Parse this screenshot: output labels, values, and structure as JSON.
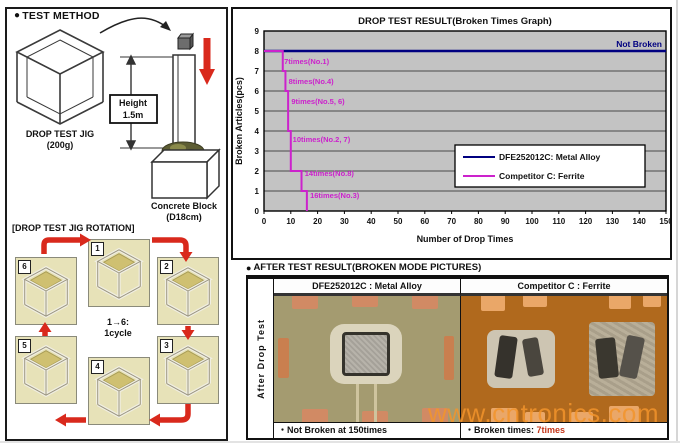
{
  "icons": {
    "bullet": "●"
  },
  "colors": {
    "arrow_red": "#d9291c",
    "navy": "#000080",
    "magenta": "#cc22cc",
    "plot_bg": "#c3c3c3",
    "photo_left_bg": "#a49b70",
    "photo_right_bg": "#b0691d",
    "watermark_orange": "#f29430"
  },
  "left_panel": {
    "title": "TEST METHOD",
    "jig": {
      "label": "DROP TEST JIG",
      "weight": "(200g)"
    },
    "height_box": {
      "line1": "Height",
      "line2": "1.5m"
    },
    "block": {
      "label": "Concrete Block",
      "size": "(D18cm)"
    },
    "rotation": {
      "title": "[DROP TEST JIG ROTATION]",
      "cycle_note_line1": "1→6:",
      "cycle_note_line2": "1cycle",
      "photo_numbers": [
        "1",
        "2",
        "3",
        "4",
        "5",
        "6"
      ]
    }
  },
  "chart_data": {
    "type": "line",
    "title": "DROP TEST RESULT(Broken Times Graph)",
    "xlabel": "Number of Drop Times",
    "ylabel": "Broken Articles(pcs)",
    "xlim": [
      0,
      150
    ],
    "ylim": [
      0,
      9
    ],
    "xticks": [
      0,
      10,
      20,
      30,
      40,
      50,
      60,
      70,
      80,
      90,
      100,
      110,
      120,
      130,
      140,
      150
    ],
    "yticks": [
      0,
      1,
      2,
      3,
      4,
      5,
      6,
      7,
      8,
      9
    ],
    "grid": "horizontal",
    "legend_position": "inside-right",
    "series": [
      {
        "name": "DFE252012C: Metal Alloy",
        "color": "#000080",
        "points": [
          [
            0,
            8
          ],
          [
            150,
            8
          ]
        ],
        "end_label": "Not Broken"
      },
      {
        "name": "Competitor C: Ferrite",
        "color": "#cc22cc",
        "points": [
          [
            0,
            8
          ],
          [
            7,
            8
          ],
          [
            7,
            7
          ],
          [
            8,
            7
          ],
          [
            8,
            6
          ],
          [
            9,
            6
          ],
          [
            9,
            4
          ],
          [
            10,
            4
          ],
          [
            10,
            2
          ],
          [
            14,
            2
          ],
          [
            14,
            1
          ],
          [
            16,
            1
          ],
          [
            16,
            0
          ]
        ]
      }
    ],
    "annotations": [
      {
        "text": "7times(No.1)",
        "x": 7.5,
        "y": 7.35
      },
      {
        "text": "8times(No.4)",
        "x": 9.2,
        "y": 6.35
      },
      {
        "text": "9times(No.5, 6)",
        "x": 10.2,
        "y": 5.35
      },
      {
        "text": "10times(No.2, 7)",
        "x": 10.7,
        "y": 3.45
      },
      {
        "text": "14times(No.8)",
        "x": 15.2,
        "y": 1.75
      },
      {
        "text": "16times(No.3)",
        "x": 17.2,
        "y": 0.65
      }
    ]
  },
  "after_test": {
    "title": "AFTER TEST RESULT(BROKEN MODE PICTURES)",
    "row_label": "After Drop Test",
    "columns": [
      {
        "header": "DFE252012C : Metal Alloy",
        "caption": "・Not Broken at 150times"
      },
      {
        "header": "Competitor C : Ferrite",
        "caption_prefix": "・Broken times: ",
        "caption_value": "7times"
      }
    ]
  },
  "watermark": "www.cntronics.com"
}
